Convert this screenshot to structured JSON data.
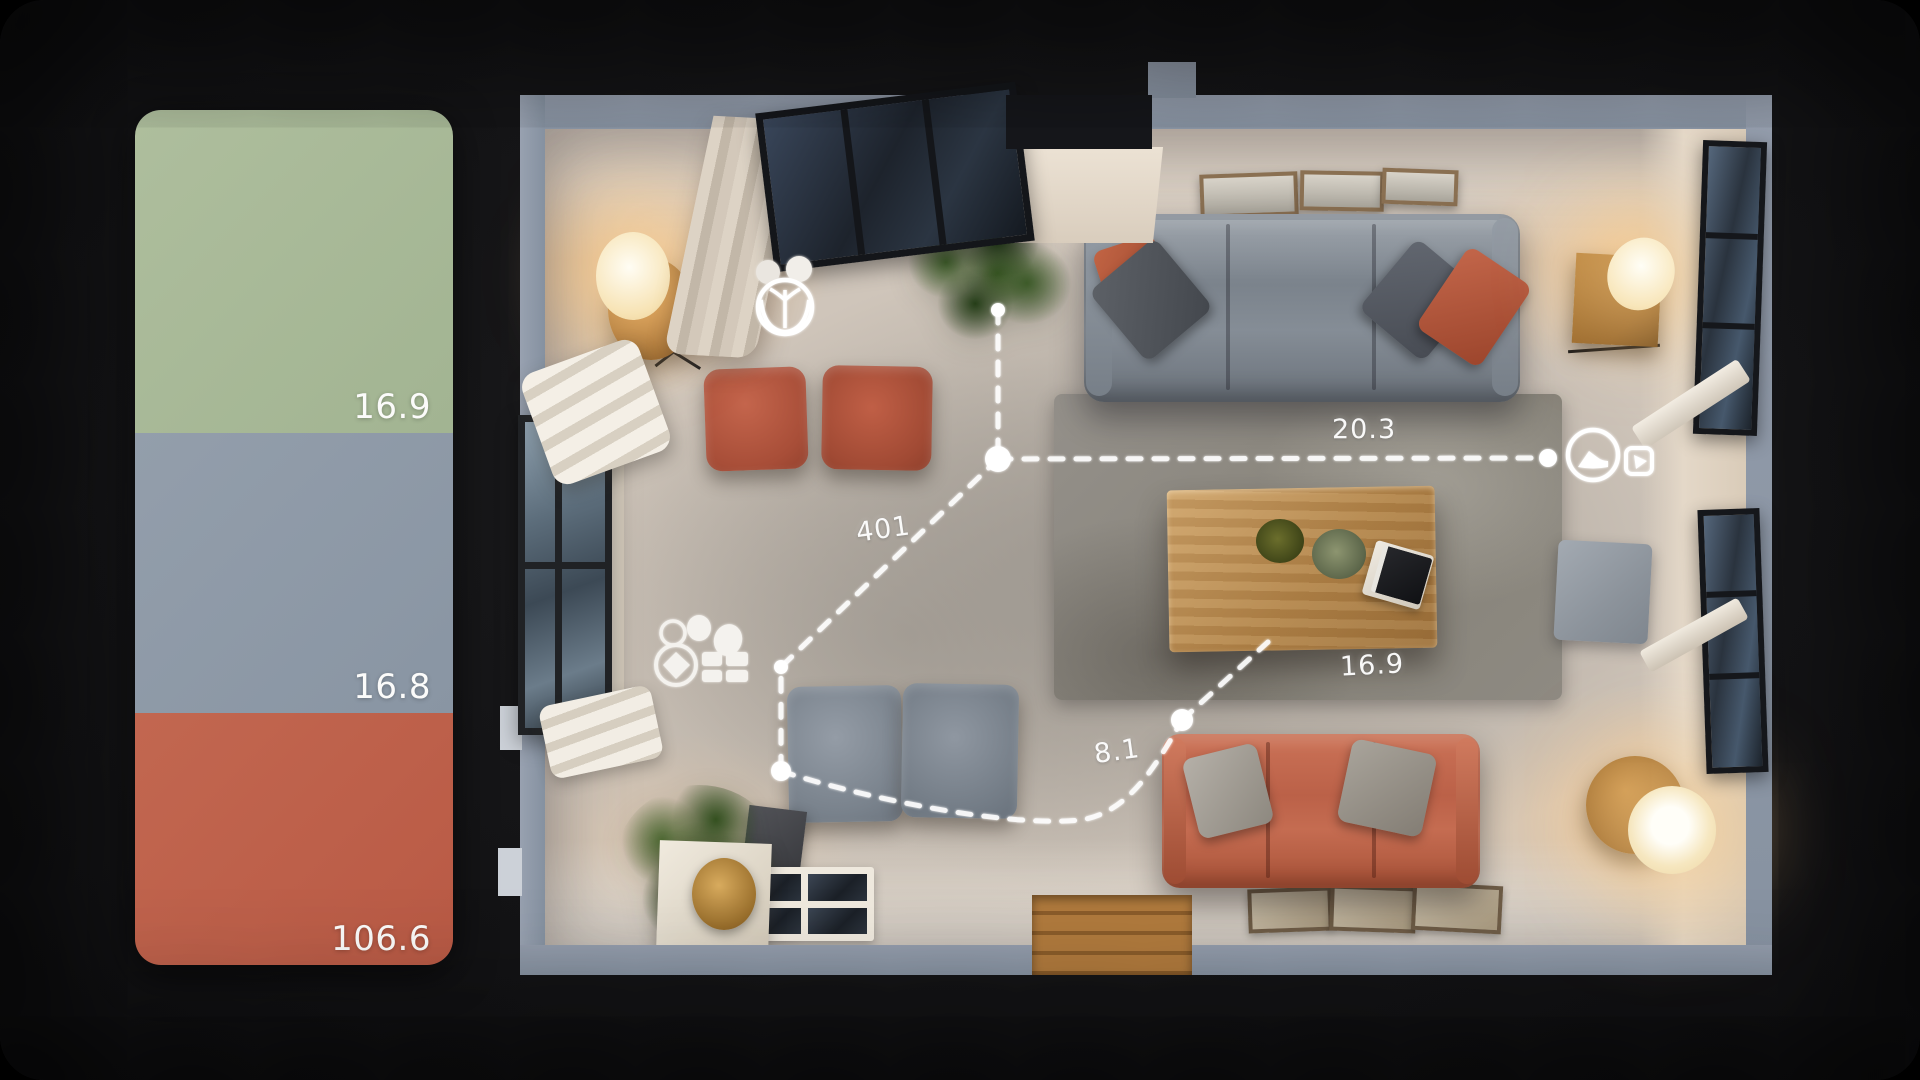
{
  "scene": {
    "background_color": "#0b0b0c",
    "wall_color": "#8a93a2",
    "floor_color": "#d5cbc0"
  },
  "palette_panel": {
    "swatches": [
      {
        "name": "sage-green",
        "color": "#a8b996",
        "label": "16.9"
      },
      {
        "name": "slate-gray",
        "color": "#8e99a6",
        "label": "16.8"
      },
      {
        "name": "terracotta",
        "color": "#bf5f4a",
        "label": "106.6"
      }
    ]
  },
  "floorplan": {
    "measurements": {
      "top": "20.3",
      "left": "401",
      "rug": "16.9",
      "bottom": "8.1"
    },
    "markers": [
      "plant-marker",
      "gem-gift-marker",
      "clock-marker",
      "cursor-marker"
    ],
    "furniture_colors": {
      "gray_sofa": "#7f8790",
      "red_sofa": "#c06a50",
      "rug": "#8e8a83",
      "wood": "#b98a4e"
    }
  }
}
